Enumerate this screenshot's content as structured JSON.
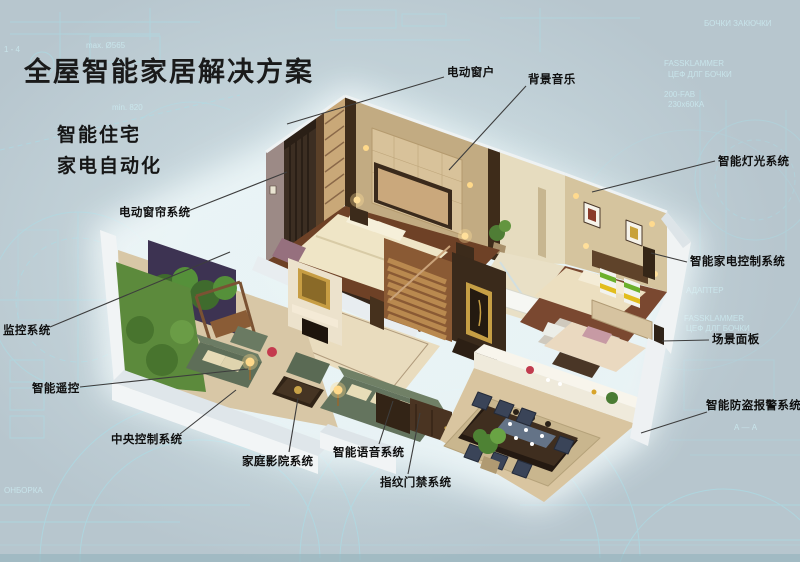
{
  "title": "全屋智能家居解决方案",
  "subtitle_lines": [
    "智能住宅",
    "家电自动化"
  ],
  "labels": [
    {
      "id": "electric-window",
      "text": "电动窗户"
    },
    {
      "id": "background-music",
      "text": "背景音乐"
    },
    {
      "id": "smart-lighting",
      "text": "智能灯光系统"
    },
    {
      "id": "smart-appliance-control",
      "text": "智能家电控制系统"
    },
    {
      "id": "scene-panel",
      "text": "场景面板"
    },
    {
      "id": "smart-burglar-alarm",
      "text": "智能防盗报警系统"
    },
    {
      "id": "electric-curtain",
      "text": "电动窗帘系统"
    },
    {
      "id": "monitoring-system",
      "text": "监控系统"
    },
    {
      "id": "smart-remote",
      "text": "智能遥控"
    },
    {
      "id": "central-control",
      "text": "中央控制系统"
    },
    {
      "id": "home-theater",
      "text": "家庭影院系统"
    },
    {
      "id": "smart-voice",
      "text": "智能语音系统"
    },
    {
      "id": "fingerprint-access",
      "text": "指纹门禁系统"
    }
  ],
  "background_texts": [
    "1 - 4",
    "max. Ø565",
    "min. 820",
    "БОЧКИ ЗАКЮЧКИ",
    "FASSKLAMMER",
    "ЦЕФ ДЛГ БОЧКИ",
    "200-FAB",
    "230х60КА",
    "АДАПТЕР",
    "FASSKLAMMER",
    "ЦЕФ ДЛГ БОЧКИ",
    "А — А",
    "ОНБОРКА"
  ],
  "colors": {
    "background": "#b7c6ce",
    "blueprint_line": "#a9dfe9",
    "title_text": "#1a1a1a",
    "label_text": "#0f0f0f",
    "leader_line": "#3d3d3d",
    "glow": "#f2fbfc"
  }
}
